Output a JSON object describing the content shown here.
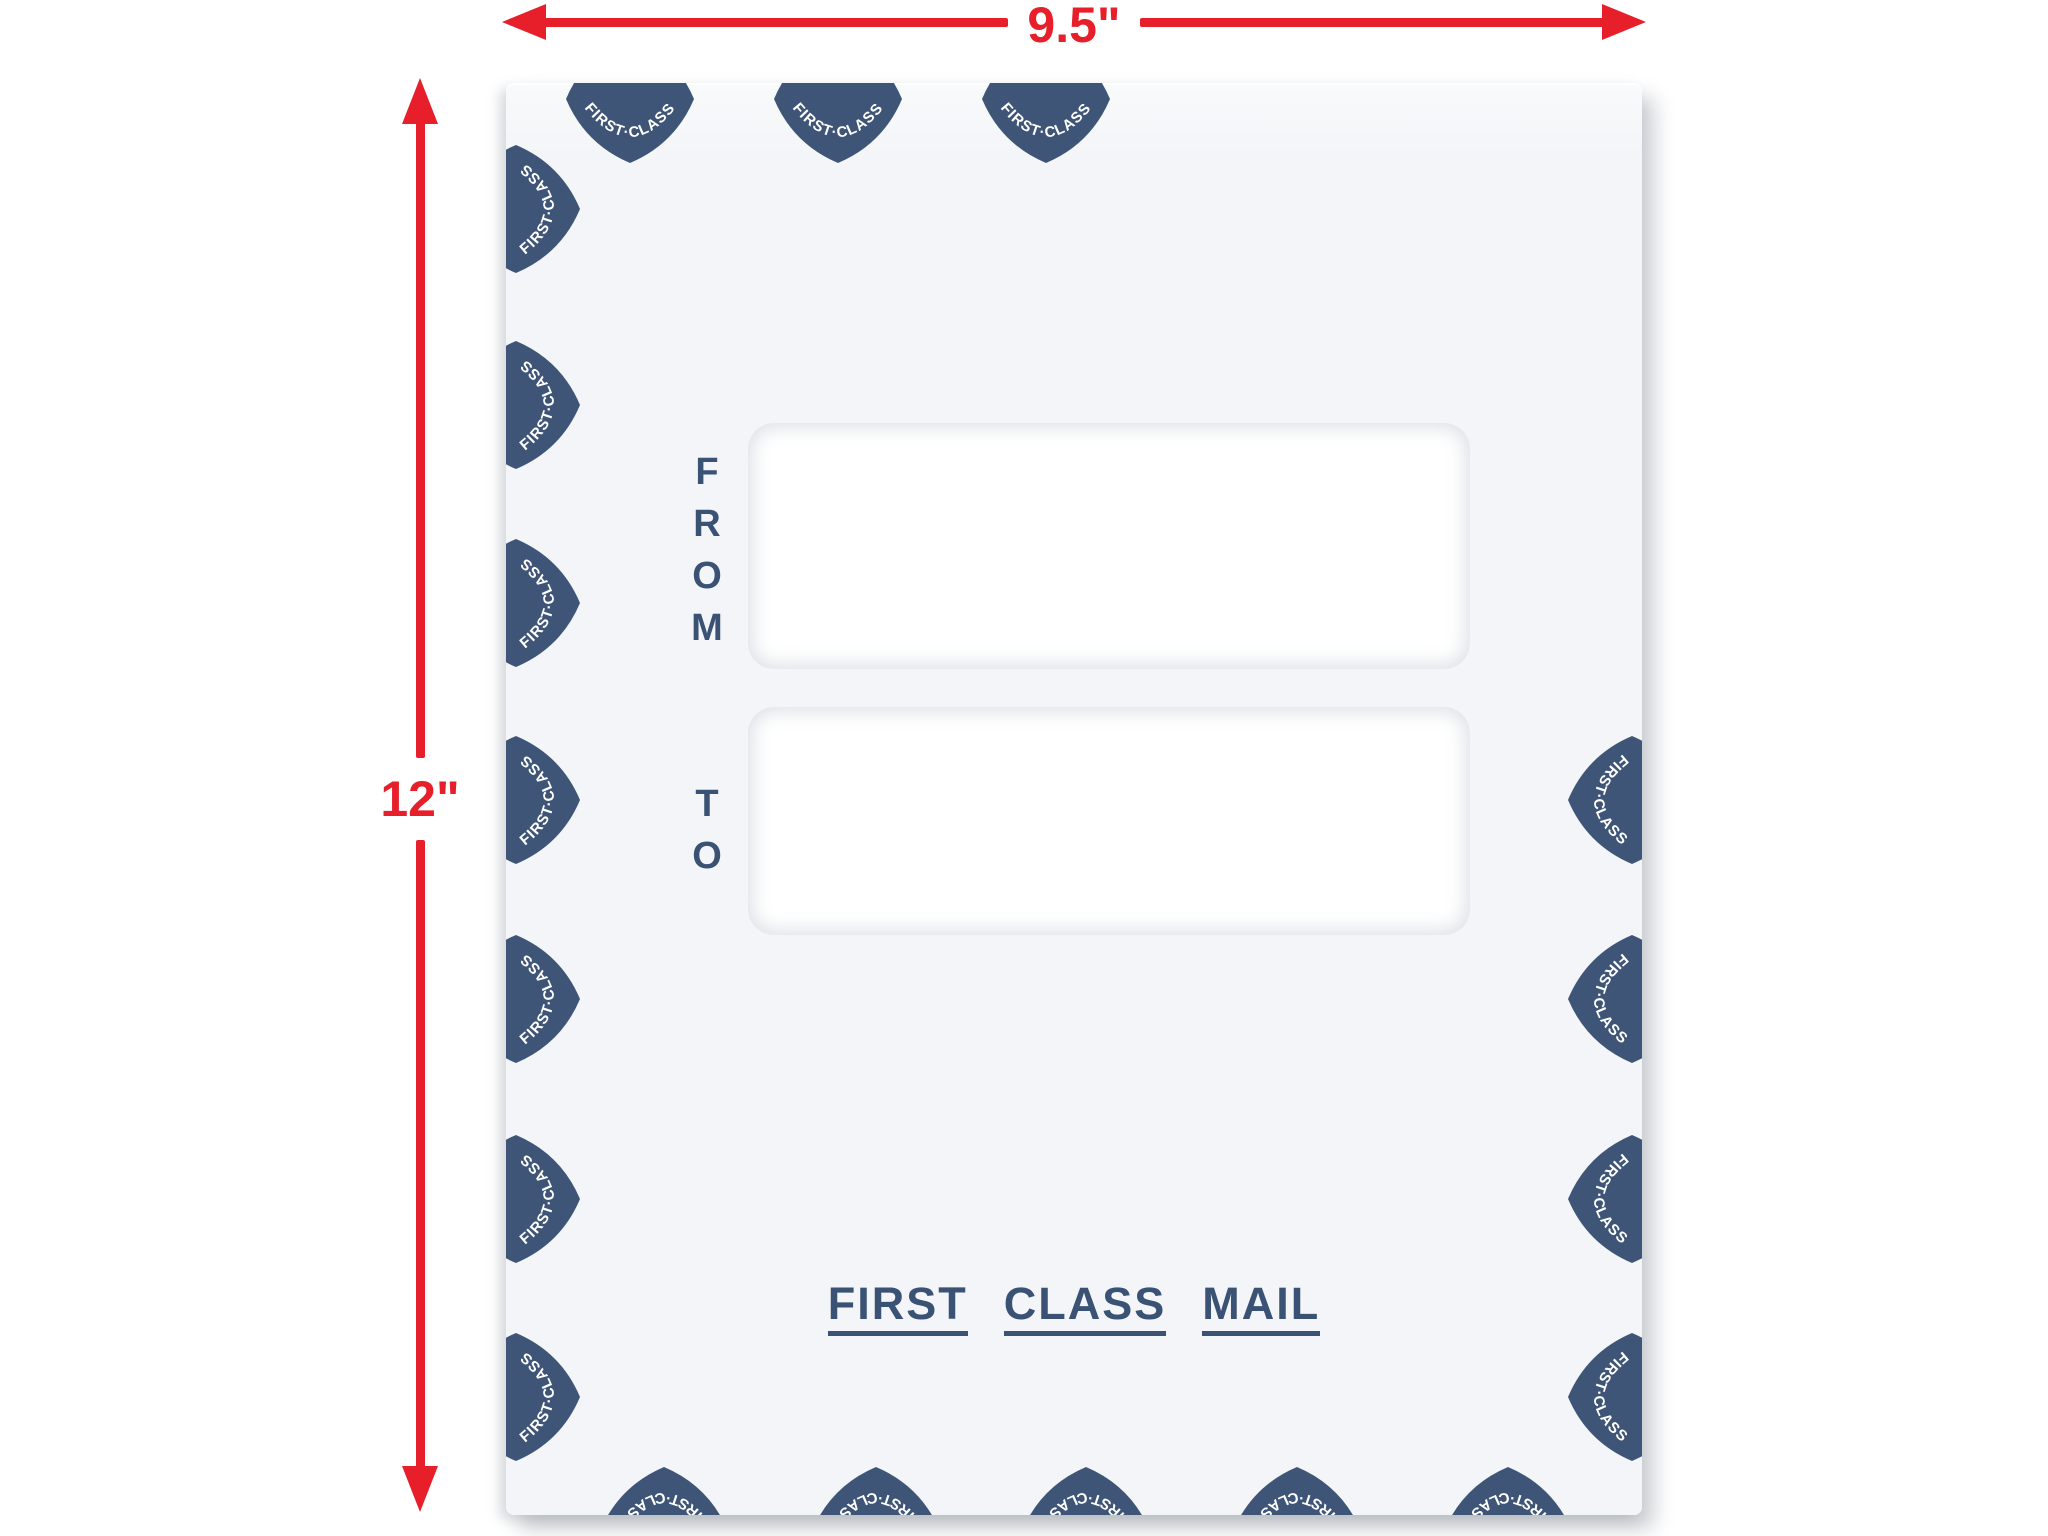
{
  "scene": {
    "description": "First class mail double-window envelope product illustration with size callouts",
    "background": "#ffffff"
  },
  "dimension_annotations": {
    "color": "#e71f2b",
    "width": {
      "label": "9.5\""
    },
    "height": {
      "label": "12\""
    }
  },
  "envelope": {
    "background": "#f3f5f8",
    "from_window": {
      "label": "FROM"
    },
    "to_window": {
      "label": "TO"
    },
    "footer_stamp": {
      "color": "#3a5273",
      "words": [
        "FIRST",
        "CLASS",
        "MAIL"
      ]
    },
    "border_badge": {
      "label": "FIRST·CLASS",
      "fill": "#3e5577",
      "text_color": "#ffffff",
      "positions": {
        "top": [
          {
            "x": 124,
            "y": 16,
            "r": 0
          },
          {
            "x": 332,
            "y": 16,
            "r": 0
          },
          {
            "x": 540,
            "y": 16,
            "r": 0
          }
        ],
        "left": [
          {
            "x": 10,
            "y": 126,
            "r": -90
          },
          {
            "x": 10,
            "y": 322,
            "r": -90
          },
          {
            "x": 10,
            "y": 520,
            "r": -90
          },
          {
            "x": 10,
            "y": 717,
            "r": -90
          },
          {
            "x": 10,
            "y": 916,
            "r": -90
          },
          {
            "x": 10,
            "y": 1116,
            "r": -90
          },
          {
            "x": 10,
            "y": 1314,
            "r": -90
          }
        ],
        "right": [
          {
            "x": 1126,
            "y": 717,
            "r": 90
          },
          {
            "x": 1126,
            "y": 916,
            "r": 90
          },
          {
            "x": 1126,
            "y": 1116,
            "r": 90
          },
          {
            "x": 1126,
            "y": 1314,
            "r": 90
          }
        ],
        "bottom": [
          {
            "x": 158,
            "y": 1448,
            "r": 180
          },
          {
            "x": 370,
            "y": 1448,
            "r": 180
          },
          {
            "x": 580,
            "y": 1448,
            "r": 180
          },
          {
            "x": 791,
            "y": 1448,
            "r": 180
          },
          {
            "x": 1002,
            "y": 1448,
            "r": 180
          }
        ]
      }
    }
  }
}
